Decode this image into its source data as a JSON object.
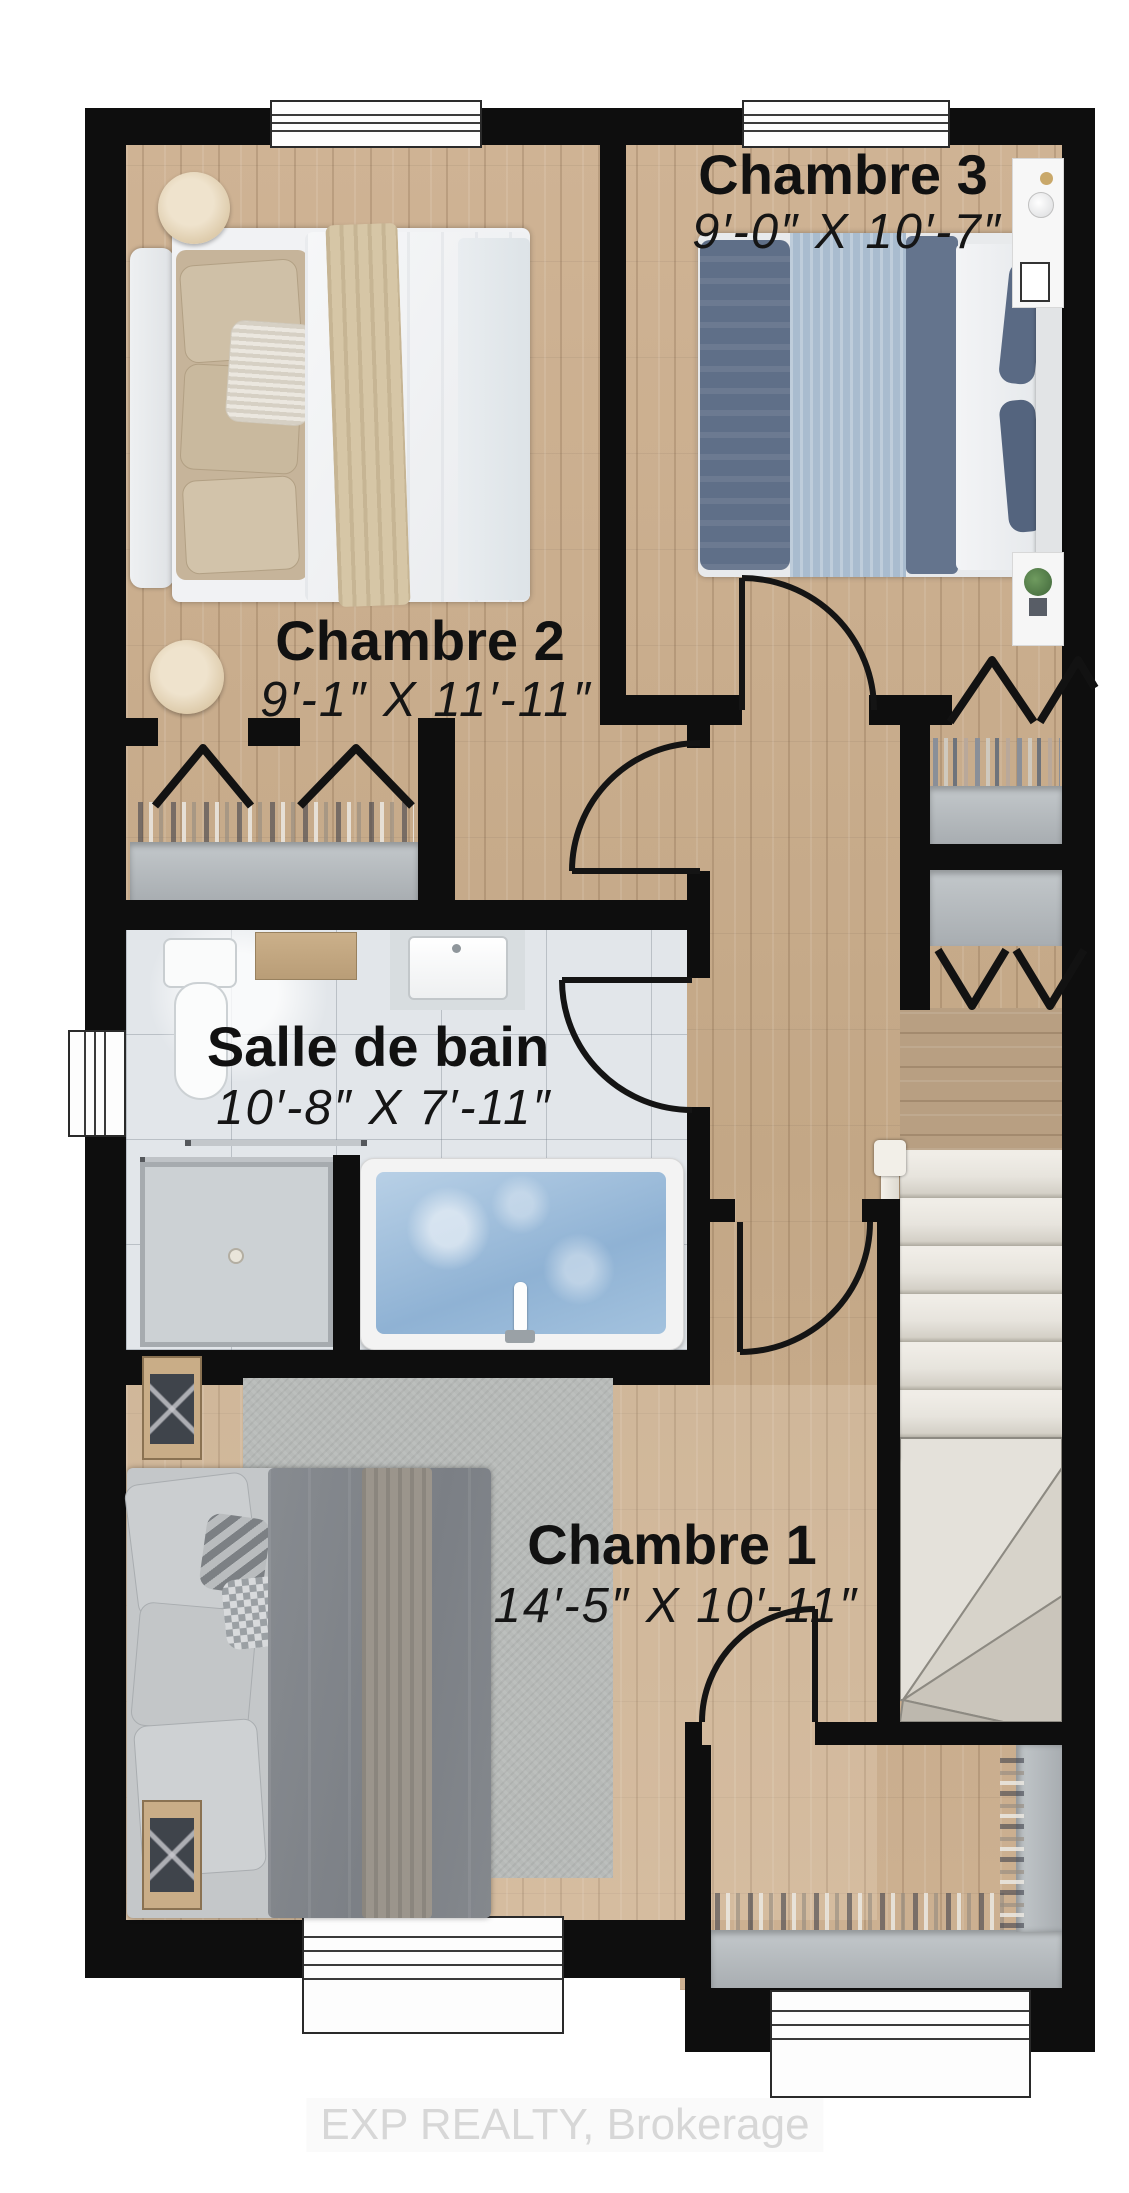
{
  "plan": {
    "type": "floor-plan",
    "rooms": [
      {
        "id": "chambre3",
        "name": "Chambre 3",
        "dimensions": "9′-0″ X 10′-7″"
      },
      {
        "id": "chambre2",
        "name": "Chambre 2",
        "dimensions": "9′-1″ X 11′-11″"
      },
      {
        "id": "salle-de-bain",
        "name": "Salle de bain",
        "dimensions": "10′-8″ X 7′-11″"
      },
      {
        "id": "chambre1",
        "name": "Chambre 1",
        "dimensions": "14′-5″ X 10′-11″"
      }
    ],
    "colors": {
      "wall": "#0e0e0e",
      "wood_floor": "#c8ad8e",
      "bathroom_tile": "#e2e6ea",
      "tub_water": "#a3c2de",
      "closet_shelf": "#b0b5b8",
      "stair_tread": "#e7e4dd"
    }
  },
  "watermark": {
    "text": "EXP REALTY, Brokerage"
  }
}
